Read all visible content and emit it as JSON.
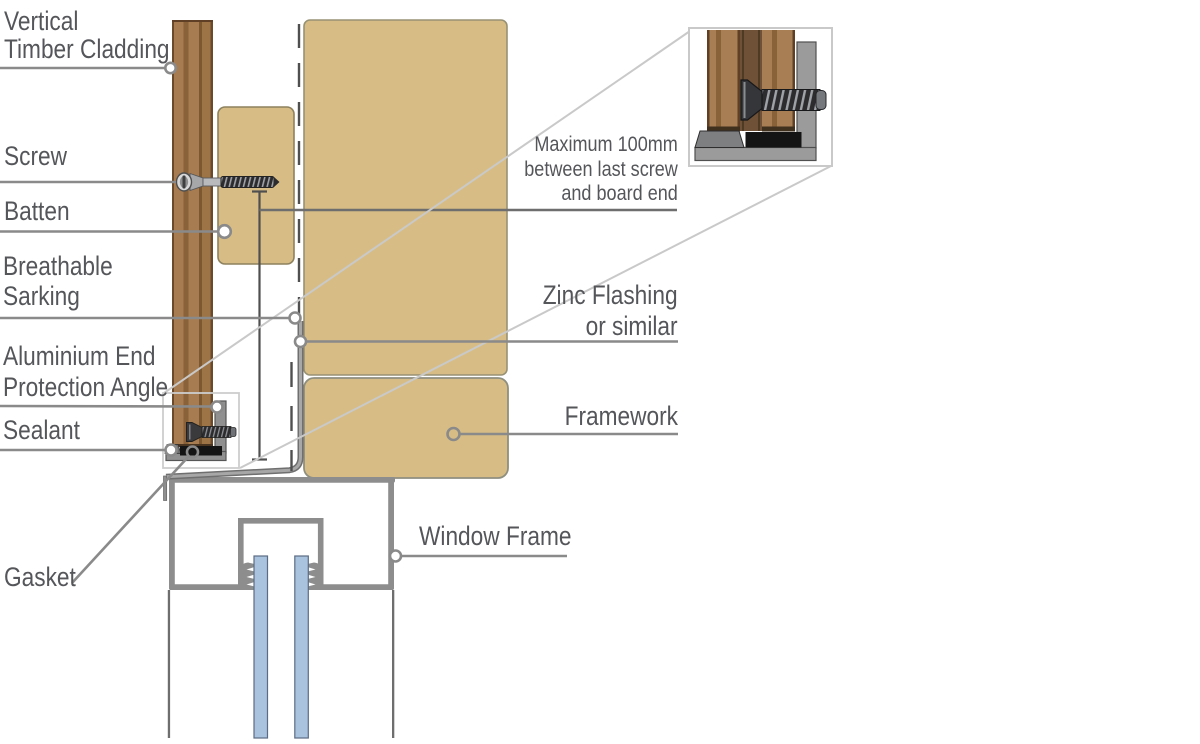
{
  "palette": {
    "background": "#ffffff",
    "text": "#55565a",
    "leader_line": "#8a8a8a",
    "dimension_line": "#4f4f4f",
    "timber_face": "#a77c51",
    "timber_groove": "#8a6239",
    "timber_edge": "#6b4a2b",
    "tan_fill": "#d7bd85",
    "tan_border": "#989274",
    "frame_gray": "#8d8d8d",
    "glass_blue": "#a9c2dd",
    "glass_edge": "#5a6c84",
    "flashing_gray": "#9a9a9a",
    "sealant_black": "#141414",
    "metal_dark": "#2c2c2e",
    "callout_gray": "#c9c9c9"
  },
  "labels": {
    "vertical_timber_cladding": {
      "line1": "Vertical",
      "line2": "Timber Cladding"
    },
    "screw": {
      "text": "Screw"
    },
    "batten": {
      "text": "Batten"
    },
    "breathable_sarking": {
      "line1": "Breathable",
      "line2": "Sarking"
    },
    "aluminium_end_protection_angle": {
      "line1": "Aluminium End",
      "line2": "Protection Angle"
    },
    "sealant": {
      "text": "Sealant"
    },
    "gasket": {
      "text": "Gasket"
    },
    "max_screw_note": {
      "line1": "Maximum 100mm",
      "line2": "between last screw",
      "line3": "and board end"
    },
    "zinc_flashing": {
      "line1": "Zinc Flashing",
      "line2": "or similar"
    },
    "framework": {
      "text": "Framework"
    },
    "window_frame": {
      "text": "Window Frame"
    }
  }
}
